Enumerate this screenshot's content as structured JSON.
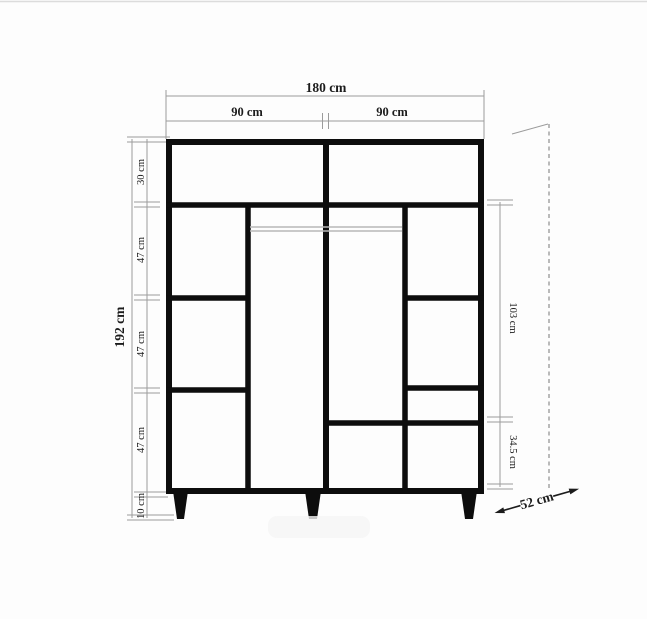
{
  "diagram": {
    "kind": "furniture-dimension-drawing",
    "subject": "wardrobe front elevation with legs and hanging rails",
    "units": "cm"
  },
  "dims": {
    "total_width": "180 cm",
    "left_half_width": "90 cm",
    "right_half_width": "90 cm",
    "total_height": "192 cm",
    "top_shelf_height": "30 cm",
    "shelf_height_1": "47 cm",
    "shelf_height_2": "47 cm",
    "shelf_height_3": "47 cm",
    "leg_height": "10 cm",
    "right_upper_span": "103 cm",
    "right_lower_span": "34.5 cm",
    "depth": "52 cm"
  },
  "colors": {
    "structure_line": "#0d0d0d",
    "dimension_line": "#9b9b9b",
    "rail_line": "#b8b8b8",
    "dashed_depth_line": "#8d8d8d",
    "background": "#fdfdfd"
  }
}
